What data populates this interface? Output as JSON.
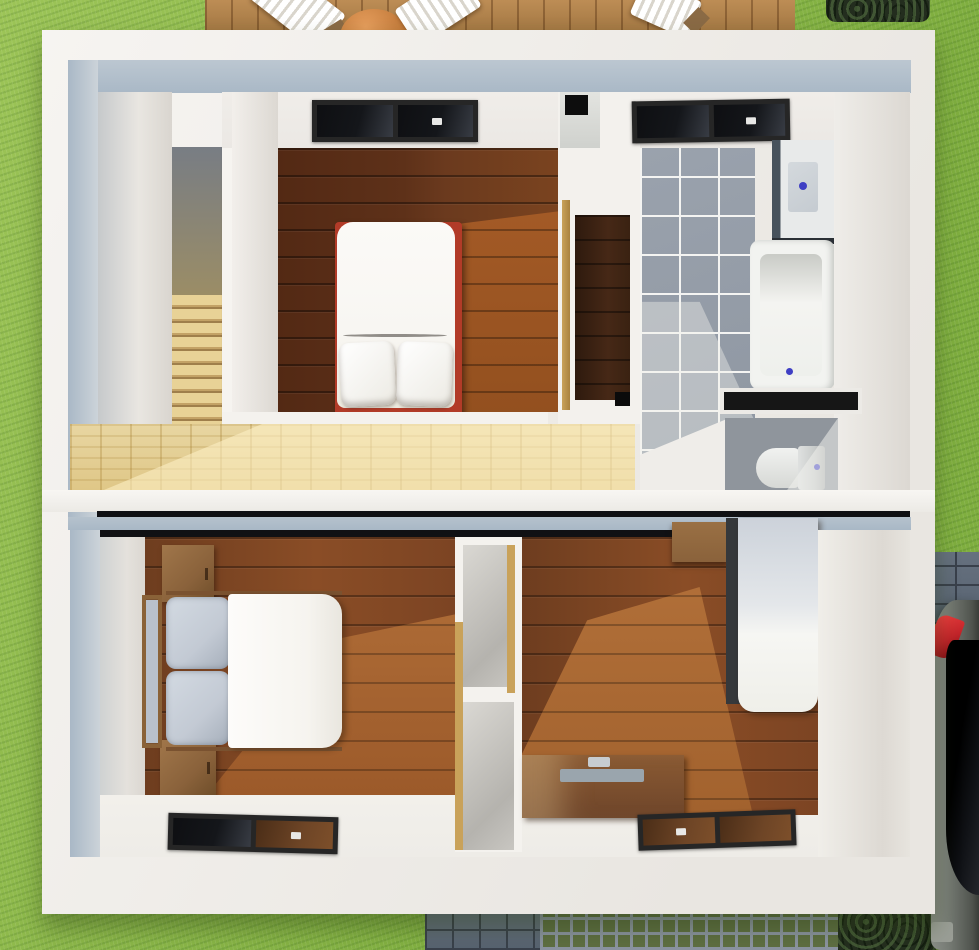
{
  "scene": {
    "title": "3D cutaway floor plan render – two-storey house viewed from above",
    "labels": {
      "lawn": "Lawn",
      "deck": "Wooden roof deck",
      "deck_table": "Round patio table",
      "deck_chair": "Folding deck chair",
      "hedge": "Hedge",
      "cobbles": "Cobblestone paving",
      "grid_pavers": "Grass-grid pavers",
      "car": "Parked car",
      "house": "House cutaway",
      "stairs": "Staircase",
      "bedroom1": "Upper bedroom",
      "bed1": "Double bed with red frame",
      "skylight": "Roof window",
      "wardrobe": "Wardrobe nook",
      "bathroom": "Bathroom",
      "shower": "Shower unit",
      "bathtub": "Bathtub",
      "wc": "WC",
      "toilet": "Toilet",
      "landing": "Landing",
      "bedroom2": "Lower-left bedroom",
      "bed2": "Double bed",
      "nightstand": "Bedside cabinet",
      "shelves": "Open shelving",
      "bedroom3": "Lower-right bedroom",
      "bed3": "Single bed",
      "cabinet": "Wall cabinet",
      "desk": "Desk",
      "floor_window": "Floor-level window"
    },
    "palette": {
      "grassA": "#9cc457",
      "grassB": "#7fae3f",
      "deckA": "#bd8d55",
      "deckB": "#a17642",
      "wallA": "#f6f4f1",
      "wallB": "#e9e6e1",
      "blueWall": "#a9b8c6",
      "ceil": "#ebe8e4",
      "woodDarkA": "#532914",
      "woodDarkB": "#7a431f",
      "woodSunA": "#a85d28",
      "woodMidA": "#6e3d1f",
      "woodMidB": "#8a4d26",
      "woodMidSun": "#b3713a",
      "landA": "#e8d6a2",
      "landB": "#dfc787",
      "stairA": "#e8d296",
      "stairB": "#9f7f4b",
      "tileA": "#9aa2ad",
      "tileB": "#8e96a1",
      "grout": "#f4f4f2",
      "showerDark": "#47525c",
      "tray": "#c5cbd1",
      "drain": "#3f3fc4",
      "tubWhite": "#f2f3f0",
      "wcFloor": "#8f959c",
      "toiletA": "#f1f2f0",
      "cistern": "#c9cccb",
      "frameDark": "#262626",
      "glassDark": "#14161a",
      "glassBrown": "#6e4526",
      "bedRed": "#b23b28",
      "matt": "#f8f6f2",
      "duvet": "#f6f4ef",
      "pGray": "#c3cad4",
      "furn": "#8a623b",
      "tan": "#c9a25a",
      "paveA": "#66717f",
      "paveLine": "#39404b",
      "gridGreen": "#5e6e42",
      "gridLine": "#8b93a0",
      "bushD": "#232d1e",
      "carA": "#787d76",
      "carDark": "#101216",
      "carRed": "#c2252a",
      "lineDark": "#101114",
      "stripWhite": "#eeece7"
    }
  }
}
